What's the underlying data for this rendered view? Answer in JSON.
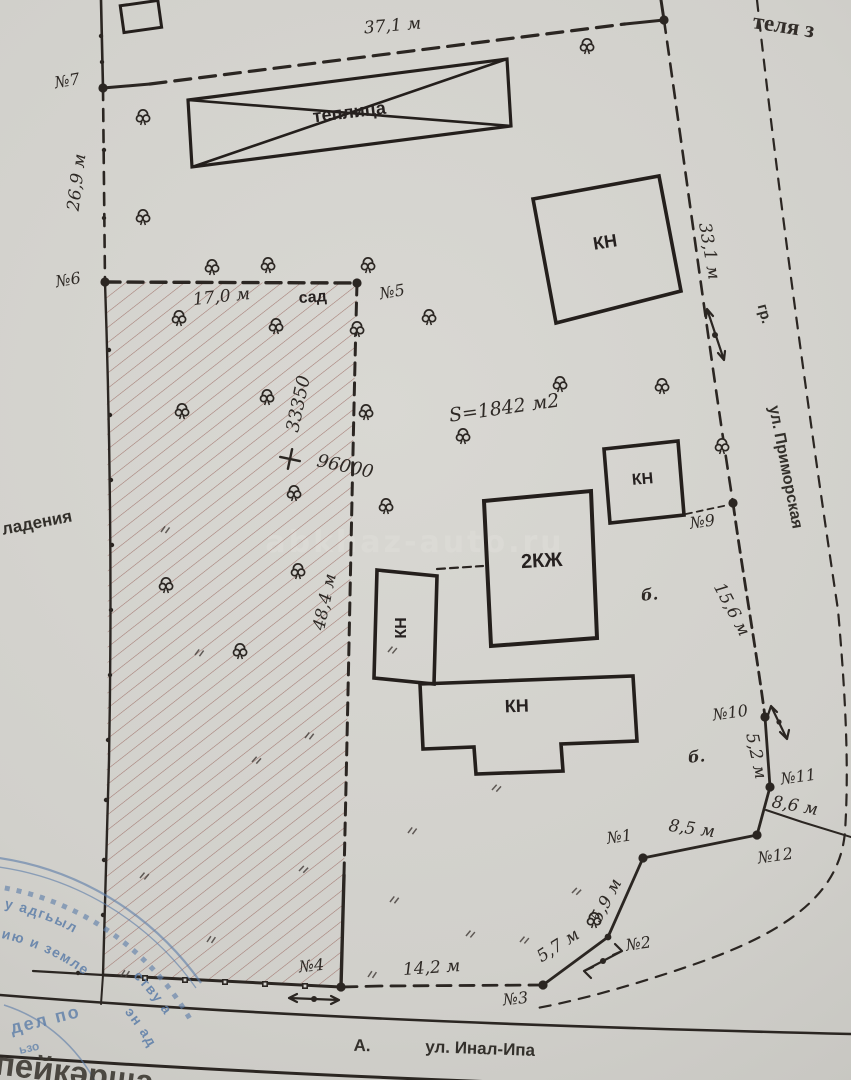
{
  "colors": {
    "paper": "#d3d2cd",
    "ink": "#2b2622",
    "hatch": "#97635a",
    "stamp_blue": "#5d7ea9",
    "watermark": "#dddcd7"
  },
  "watermark": "abkhaz-auto.ru",
  "corner_fragment": "теля з",
  "plan": {
    "area": "S=1842 м2",
    "coord_vertical": "33350",
    "coord_horizontal": "96000",
    "garden": "сад",
    "ownership_fragment": "ладения",
    "aux_mark": "б."
  },
  "buildings": {
    "greenhouse": "теплица",
    "outbuilding": "КН",
    "residential": "2КЖ"
  },
  "streets": {
    "right_boundary_abbr": "гр.",
    "right": "ул. Приморская",
    "bottom": "ул. Инал-Ипа",
    "bottom_letter": "А."
  },
  "dims": {
    "top": "37,1 м",
    "left": "26,9 м",
    "garden_top": "17,0 м",
    "garden_right": "48,4 м",
    "street_right": "33,1 м",
    "right_mid": "15,6 м",
    "s52": "5,2 м",
    "s86": "8,6 м",
    "s85": "8,5 м",
    "s59": "5,9 м",
    "s57": "5,7 м",
    "bottom": "14,2 м"
  },
  "points": {
    "n1": "№1",
    "n2": "№2",
    "n3": "№3",
    "n4": "№4",
    "n5": "№5",
    "n6": "№6",
    "n7": "№7",
    "n9": "№9",
    "n10": "№10",
    "n11": "№11",
    "n12": "№12"
  },
  "stamp": {
    "ring_outer": "у адгьыл",
    "ring_outer_b": "ству а",
    "ring_inner": "ию и земле",
    "ring_inner_b": "эн ад",
    "dept": "дел по",
    "frag": "ьзо",
    "title": "пейкəрша"
  }
}
